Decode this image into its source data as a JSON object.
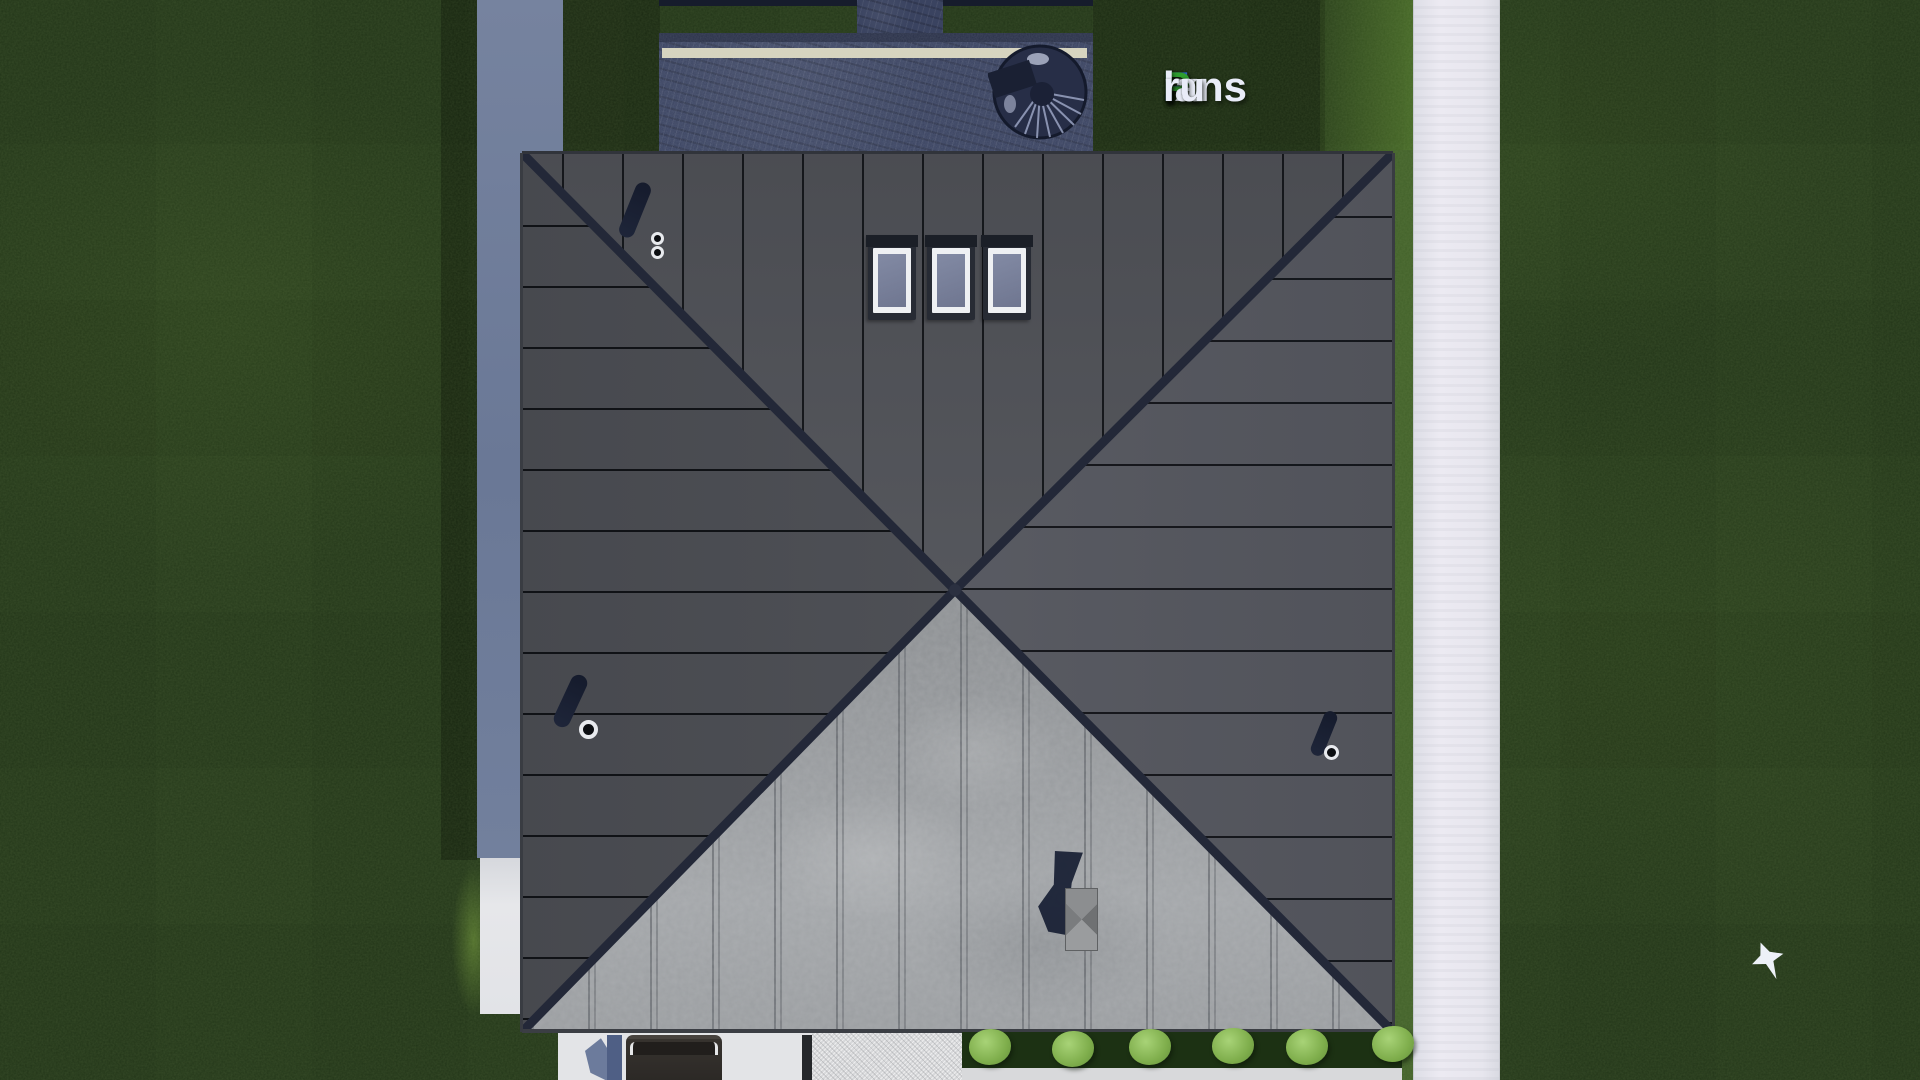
{
  "watermark": {
    "text": "FixPlans.ru",
    "segments": {
      "f": "F",
      "ix": "ix",
      "p": "P",
      "lans": "lans",
      "dot": ".",
      "ru": "ru"
    },
    "colors": {
      "blue": "#2e6fdd",
      "green": "#2f9e2f",
      "light": "#e9ecf8"
    }
  },
  "scene": {
    "description": "Aerial top-down 3D render of a house with a dark standing-seam hip roof, lawn, terrace with spiral stair, sidewalk, driveway with car, hedge bushes and a flying bird",
    "colors": {
      "grass": "#263a1b",
      "roof_dark_faces": "#53555b",
      "roof_light_face": "#9da0a3",
      "hip_ridge": "#232838",
      "terrace_deck": "#3a4360",
      "deck_trim": "#d8d5bd",
      "side_wall_path": "#6f7d9d",
      "sidewalk": "#e9e8ef",
      "bush_green": "#8fc161"
    },
    "counts": {
      "skylights": 3,
      "roof_vents": 3,
      "chimneys": 1,
      "bushes": 6,
      "cars": 1,
      "birds": 1
    }
  }
}
